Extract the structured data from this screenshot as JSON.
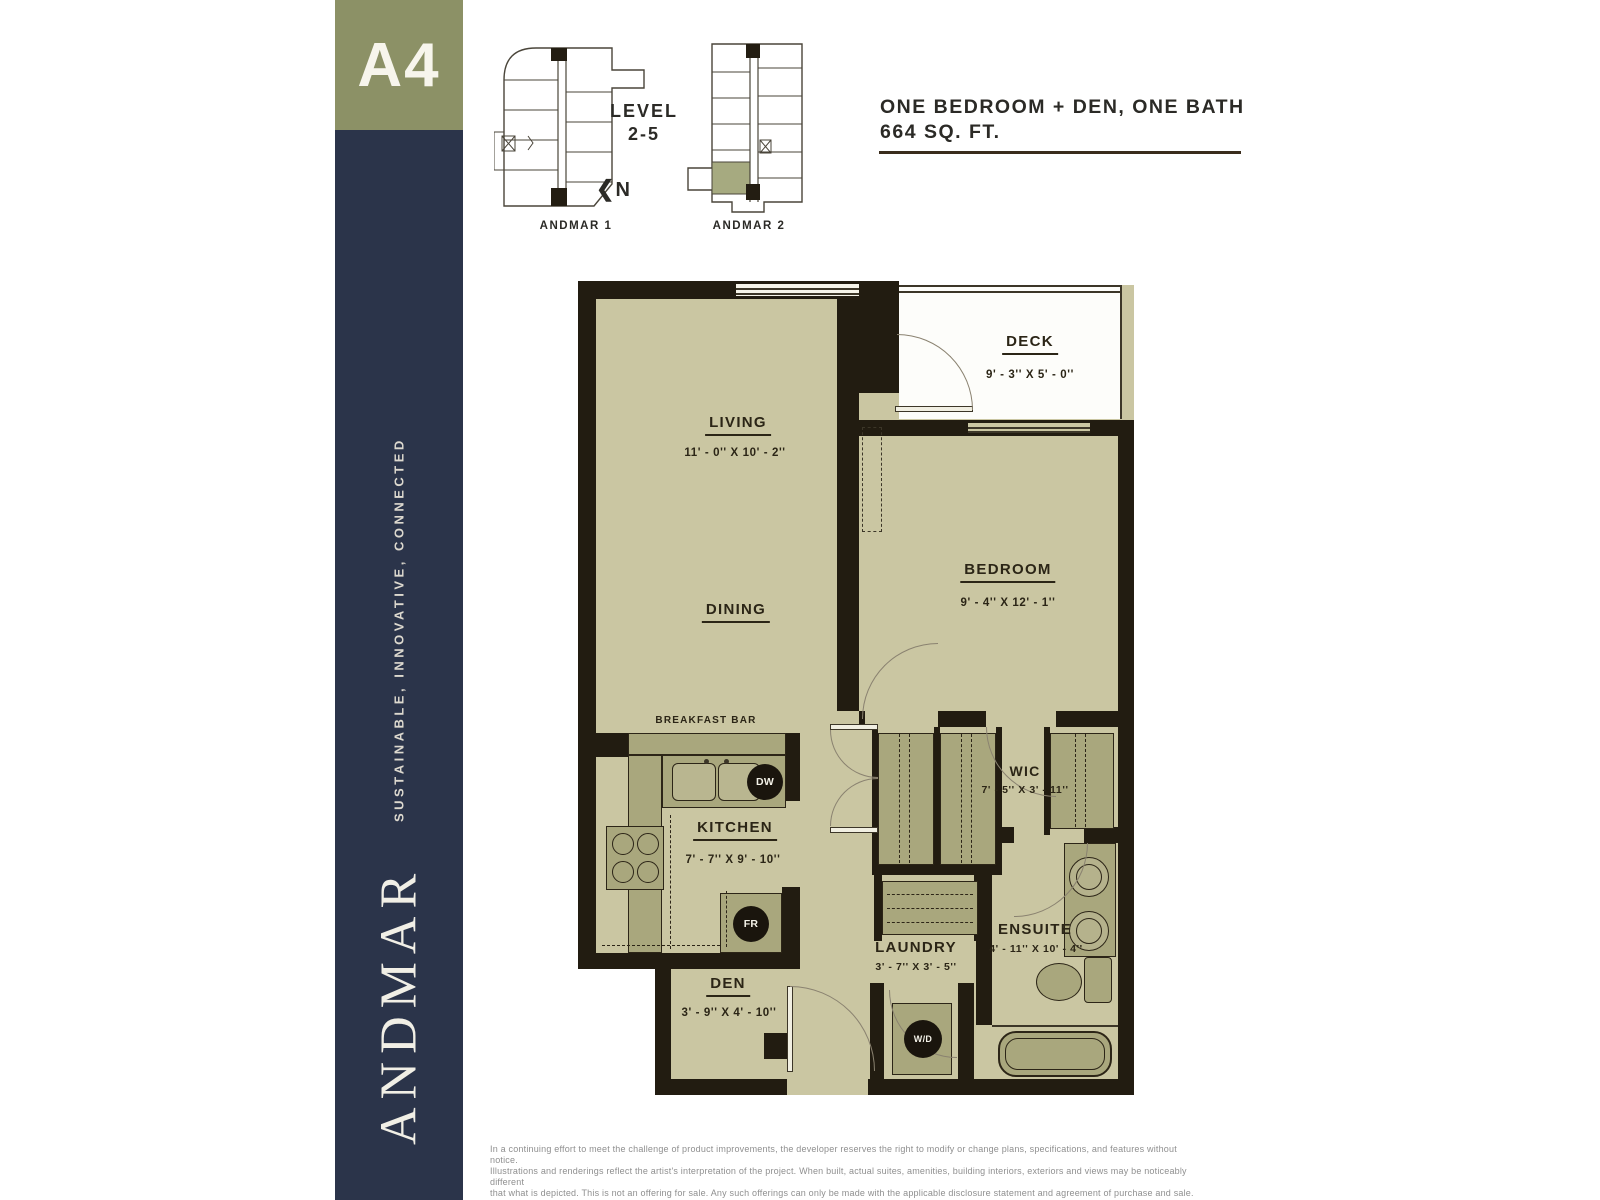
{
  "palette": {
    "navy": "#2b344a",
    "olive": "#8c9166",
    "floor": "#cac6a2",
    "fixture": "#a9a77d",
    "wall": "#221c11",
    "highlight_unit": "#a6aa80",
    "title_text": "#2b2a26",
    "disclaimer_gray": "#8f8f8f"
  },
  "sidebar": {
    "unit_code": "A4",
    "tagline": "SUSTAINABLE, INNOVATIVE, CONNECTED",
    "brand": "ANDMAR"
  },
  "keyplan": {
    "level_line1": "LEVEL",
    "level_line2": "2-5",
    "north_arrow": "❮",
    "north": "N",
    "building1": "ANDMAR 1",
    "building2": "ANDMAR 2"
  },
  "header": {
    "title": "ONE BEDROOM + DEN, ONE BATH",
    "area": "664 SQ. FT."
  },
  "floorplan": {
    "living": {
      "label": "LIVING",
      "dims": "11' - 0'' X 10' - 2''"
    },
    "dining": {
      "label": "DINING"
    },
    "deck": {
      "label": "DECK",
      "dims": "9' - 3'' X 5' - 0''"
    },
    "bedroom": {
      "label": "BEDROOM",
      "dims": "9' - 4'' X 12' - 1''"
    },
    "wic": {
      "label": "WIC",
      "dims": "7' - 5'' X 3' - 11''"
    },
    "kitchen": {
      "label": "KITCHEN",
      "dims": "7' - 7'' X 9' - 10''"
    },
    "breakfast_bar": {
      "label": "BREAKFAST BAR"
    },
    "laundry": {
      "label": "LAUNDRY",
      "dims": "3' - 7'' X 3' - 5''"
    },
    "ensuite": {
      "label": "ENSUITE",
      "dims": "4' - 11'' X 10' - 4''"
    },
    "den": {
      "label": "DEN",
      "dims": "3' - 9'' X 4' - 10''"
    },
    "appliances": {
      "dishwasher": "DW",
      "fridge": "FR",
      "washer_dryer": "W/D"
    }
  },
  "disclaimer": {
    "line1": "In a continuing effort to meet the challenge of product improvements, the developer reserves the right to modify or change plans, specifications, and features without notice.",
    "line2": "Illustrations and renderings reflect the artist's interpretation of the project. When built, actual suites, amenities, building interiors, exteriors and views may be noticeably different",
    "line3": "that what is depicted. This is not an offering for sale. Any such offerings can only be made with the applicable disclosure statement and agreement of purchase and sale. E&OE."
  }
}
